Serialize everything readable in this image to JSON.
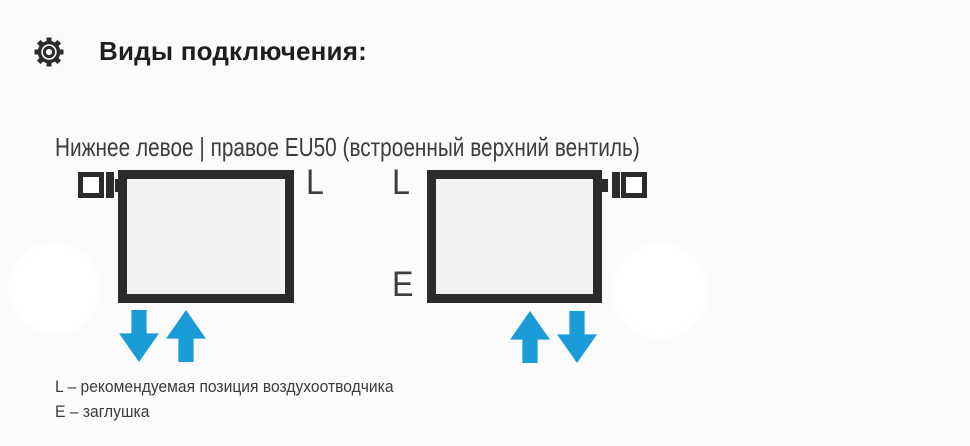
{
  "header": {
    "icon": "gear-icon",
    "title": "Виды подключения:"
  },
  "section": {
    "subtitle": "Нижнее левое | правое EU50 (встроенный верхний вентиль)"
  },
  "diagrams": {
    "left": {
      "valve_position": "top-left",
      "label_top_right": "L",
      "arrows": [
        "down",
        "up"
      ]
    },
    "right": {
      "valve_position": "top-right",
      "label_top_left": "L",
      "label_bottom_left": "E",
      "arrows": [
        "up",
        "down"
      ]
    }
  },
  "legend": {
    "line1": "L – рекомендуемая позиция воздухоотводчика",
    "line2": "E – заглушка"
  },
  "colors": {
    "arrow_blue": "#1a9cd8",
    "outline_dark": "#2b2b2b",
    "radiator_fill": "#f2f2f2",
    "text_dark": "#3a3a3c"
  }
}
